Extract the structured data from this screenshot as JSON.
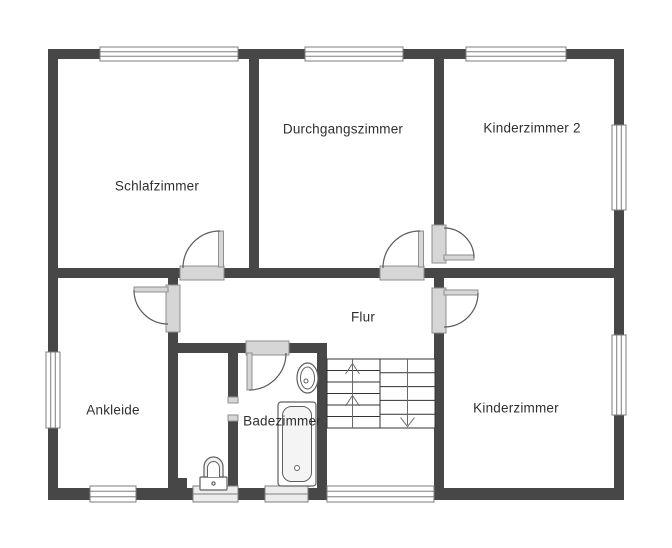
{
  "plan": {
    "type": "floor-plan",
    "rooms": [
      {
        "id": "schlafzimmer",
        "label": "Schlafzimmer"
      },
      {
        "id": "durchgangszimmer",
        "label": "Durchgangszimmer"
      },
      {
        "id": "kinderzimmer2",
        "label": "Kinderzimmer 2"
      },
      {
        "id": "flur",
        "label": "Flur"
      },
      {
        "id": "ankleide",
        "label": "Ankleide"
      },
      {
        "id": "badezimmer",
        "label": "Badezimmer"
      },
      {
        "id": "kinderzimmer",
        "label": "Kinderzimmer"
      }
    ],
    "fixtures": [
      "staircase",
      "toilet",
      "sink",
      "bathtub"
    ],
    "stairs": {
      "direction_marks": {
        "up_chevrons": 2,
        "down_arrows": 1
      }
    },
    "counts": {
      "windows": 10,
      "doors": 6
    },
    "colors": {
      "wall": "#474747",
      "floor": "#ffffff",
      "window_frame": "#7e7e7e",
      "door_threshold_fill": "#d6d6d6",
      "door_threshold_border": "#8f8f8f",
      "swing_arc": "#5a5a5a",
      "stair_line": "#333333",
      "arrow": "#6a6a6a",
      "fixture_line": "#5f5f5f",
      "text": "#2f2f2f",
      "background": "#ffffff"
    }
  }
}
